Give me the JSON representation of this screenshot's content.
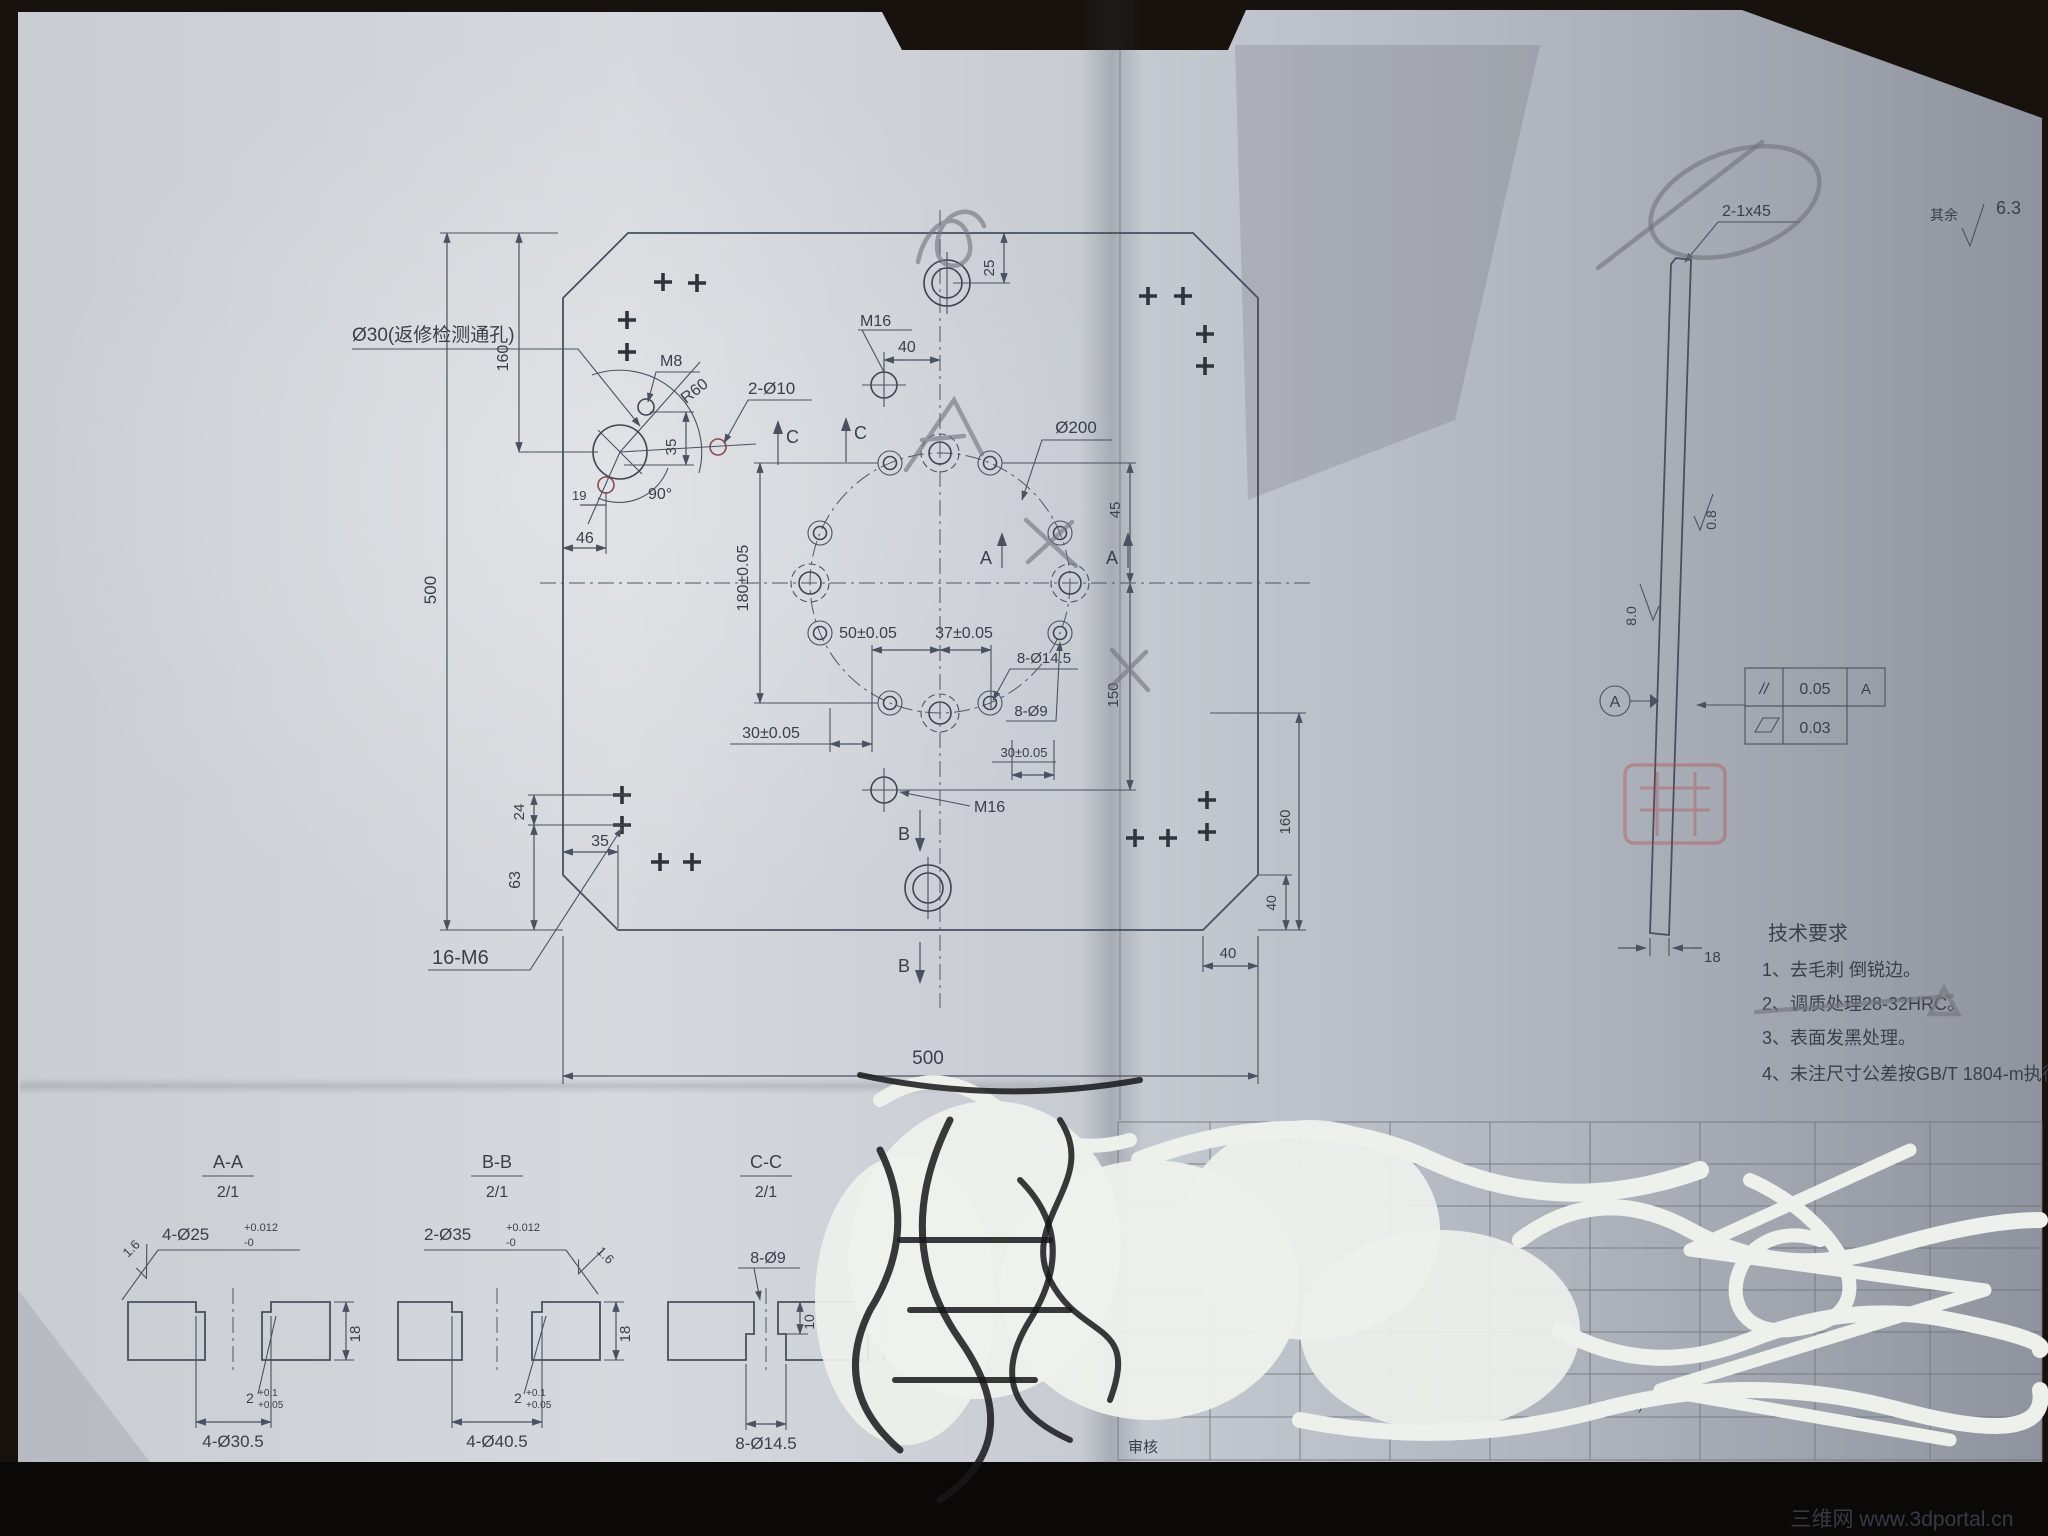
{
  "main_view": {
    "labels": {
      "hole_note": "Ø30(返修检测通孔)",
      "m8": "M8",
      "r60": "R60",
      "d2x10": "2-Ø10",
      "deg90": "90°",
      "d19": "19",
      "d46": "46",
      "d35_upper": "35",
      "d25": "25",
      "m16_top": "M16",
      "d40_top": "40",
      "d200": "Ø200",
      "d45": "45",
      "d150": "150",
      "d180": "180±0.05",
      "d50": "50±0.05",
      "d37": "37±0.05",
      "d30_left": "30±0.05",
      "d30_right": "30±0.05",
      "d8_14_5": "8-Ø14.5",
      "d8_9": "8-Ø9",
      "m16_bottom": "M16",
      "d24": "24",
      "d63": "63",
      "d35_lower": "35",
      "m6_count": "16-M6",
      "d500_left": "500",
      "d160_left": "160",
      "d500_bottom": "500",
      "d160_right": "160",
      "d40_right": "40",
      "d40_bottom": "40",
      "sec_a": "A",
      "sec_b": "B",
      "sec_c": "C"
    }
  },
  "side_view": {
    "chamfer": "2-1x45",
    "rough_right": "0.8",
    "rough_left": "8.0",
    "datum": "A",
    "fcf": {
      "parallel_sym": "//",
      "parallel_val": "0.05",
      "parallel_ref": "A",
      "flatness_val": "0.03"
    },
    "d18": "18"
  },
  "corner_note": {
    "rest": "其余",
    "value": "6.3"
  },
  "notes": {
    "title": "技术要求",
    "items": [
      "1、去毛刺 倒锐边。",
      "2、调质处理28-32HRC。",
      "3、表面发黑处理。",
      "4、未注尺寸公差按GB/T 1804-m执行。"
    ]
  },
  "sections": {
    "a": {
      "title": "A-A",
      "scale": "2/1",
      "rough": "1.6",
      "hole": "4-Ø25",
      "tol_hi": "+0.012",
      "tol_lo": "-0",
      "thk": "18",
      "depth": "2",
      "depth_hi": "+0.1",
      "depth_lo": "+0.05",
      "cbore": "4-Ø30.5"
    },
    "b": {
      "title": "B-B",
      "scale": "2/1",
      "rough": "1.6",
      "hole": "2-Ø35",
      "tol_hi": "+0.012",
      "tol_lo": "-0",
      "thk": "18",
      "depth": "2",
      "depth_hi": "+0.1",
      "depth_lo": "+0.05",
      "cbore": "4-Ø40.5"
    },
    "c": {
      "title": "C-C",
      "scale": "2/1",
      "hole": "8-Ø9",
      "depth": "10",
      "thk": "18",
      "cbore": "8-Ø14.5"
    }
  },
  "title_block": {
    "approver_label": "审核",
    "code": "(S/A/R)",
    "std": "GB/T13089-1994",
    "page": "页1"
  },
  "watermark": "三维网 www.3dportal.cn"
}
